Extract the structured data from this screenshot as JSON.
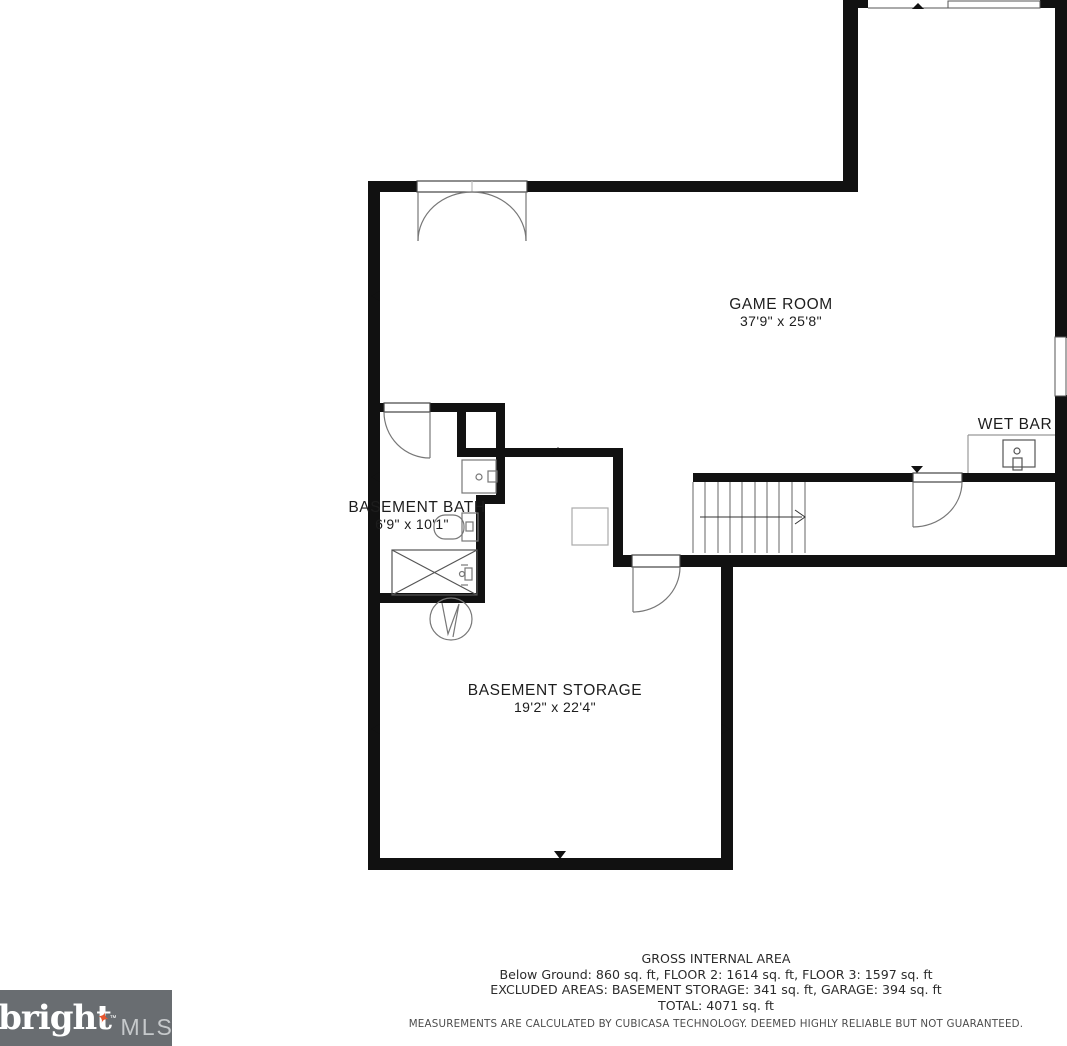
{
  "rooms": {
    "game_room": {
      "label": "GAME ROOM",
      "dims": "37'9\" x 25'8\""
    },
    "wet_bar": {
      "label": "WET BAR"
    },
    "basement_bath": {
      "label": "BASEMENT BATH",
      "dims": "6'9\" x 10'1\""
    },
    "basement_storage": {
      "label": "BASEMENT STORAGE",
      "dims": "19'2\" x 22'4\""
    }
  },
  "footer": {
    "title": "GROSS INTERNAL AREA",
    "line1": "Below Ground: 860 sq. ft, FLOOR 2: 1614 sq. ft, FLOOR 3: 1597 sq. ft",
    "line2": "EXCLUDED AREAS: BASEMENT STORAGE: 341 sq. ft, GARAGE: 394 sq. ft",
    "line3": "TOTAL: 4071 sq. ft",
    "disclaimer": "MEASUREMENTS ARE CALCULATED BY CUBICASA TECHNOLOGY. DEEMED HIGHLY RELIABLE BUT NOT GUARANTEED."
  },
  "logo": {
    "brand": "bright",
    "star": "✦",
    "tm": "™",
    "suffix": "MLS"
  },
  "colors": {
    "wall": "#111111",
    "fixture_light": "#999999",
    "fixture_dark": "#444444",
    "logo_background": "#696d71",
    "logo_star": "#e8562e",
    "logo_mls": "#c6c9cb"
  }
}
